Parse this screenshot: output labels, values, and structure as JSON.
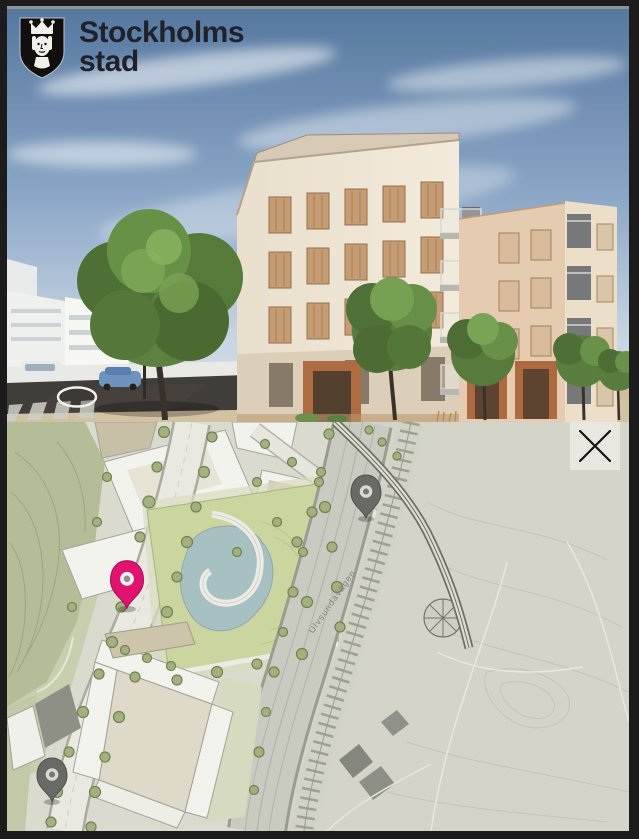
{
  "branding": {
    "logo": {
      "line1": "Stockholms",
      "line2": "stad",
      "icon": "stockholm-crest-icon",
      "shield_color": "#100f0d",
      "text_color": "#20212b"
    }
  },
  "render_view": {
    "kind": "3D exterior rendering of residential block",
    "navigation_ring_icon": "move-target-ring-icon",
    "navigation_ring_color": "#f2f2ec"
  },
  "map_view": {
    "kind": "site plan map",
    "road_label": "Ulvsundavägen",
    "close_button": {
      "icon": "close-icon",
      "color": "#141414"
    },
    "pins": {
      "selected": {
        "icon": "map-pin-icon",
        "color": "#e0146e",
        "stroke": "#ad0e55",
        "inner": "#f5eef2",
        "dot": "#8f8f89"
      },
      "other": {
        "icon": "map-pin-icon",
        "color": "#696a66",
        "stroke": "#4f504b",
        "inner": "#d9d9d3",
        "dot": "#77786f"
      }
    },
    "palette": {
      "park": "#b4bd98",
      "lawn": "#cbd5a0",
      "pond": "#a7c0c1",
      "road": "#e9e9e2",
      "terrain": "#d4d5c8"
    }
  }
}
